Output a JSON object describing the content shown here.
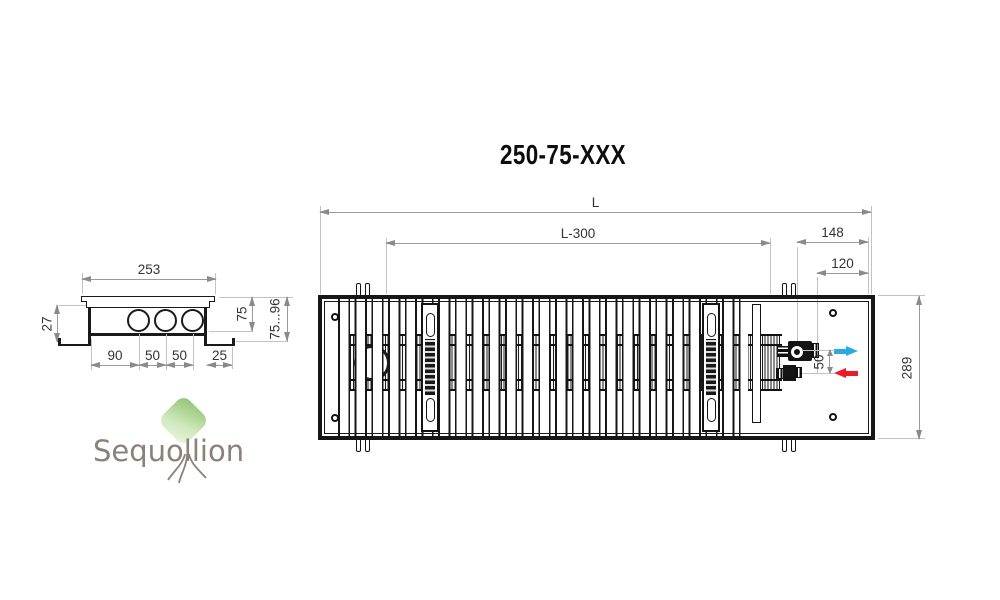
{
  "title": "250-75-XXX",
  "side_view": {
    "dimensions": {
      "top_width": "253",
      "left_height": "27",
      "pipe_spacing_1": "90",
      "pipe_spacing_2": "50",
      "pipe_spacing_3": "50",
      "flange_overhang": "25",
      "inner_height": "75",
      "height_range": "75...96"
    }
  },
  "top_view": {
    "dimensions": {
      "total_length": "L",
      "grille_length": "L-300",
      "connection_offset_outer": "148",
      "connection_offset_inner": "120",
      "pipe_gap": "50",
      "total_width": "289"
    },
    "icons": {
      "supply_arrow": "right-arrow",
      "return_arrow": "left-arrow"
    }
  },
  "logo": {
    "text": "Sequollion"
  },
  "colors": {
    "supply_arrow": "#29abe2",
    "return_arrow": "#ed1c24",
    "drawing_line": "#1a1a1a",
    "dimension_line": "#8a8a8a",
    "logo_text": "#8d8177",
    "logo_tree": "#a9d18e"
  }
}
